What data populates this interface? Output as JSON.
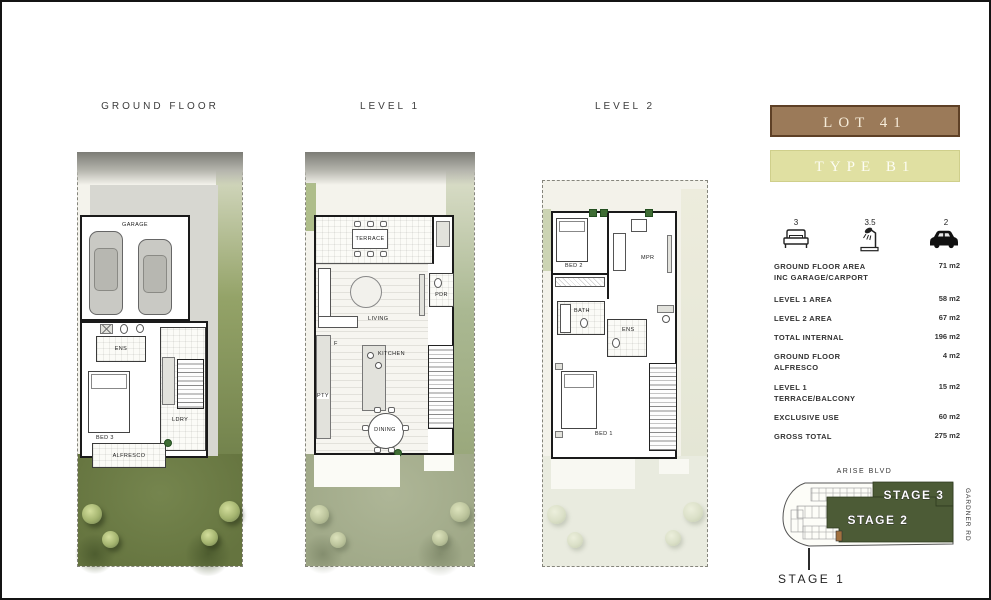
{
  "plans": {
    "ground": {
      "title": "GROUND FLOOR",
      "rooms": {
        "garage": "GARAGE",
        "ens": "ENS",
        "bed3": "BED 3",
        "ldry": "LDRY",
        "alfresco": "ALFRESCO"
      }
    },
    "level1": {
      "title": "LEVEL 1",
      "rooms": {
        "terrace": "TERRACE",
        "living": "LIVING",
        "kitchen": "KITCHEN",
        "pdr": "PDR",
        "fridge": "F",
        "pty": "PTY",
        "dining": "DINING"
      }
    },
    "level2": {
      "title": "LEVEL 2",
      "rooms": {
        "bed2": "BED 2",
        "mpr": "MPR",
        "bath": "BATH",
        "ens": "ENS",
        "bed1": "BED 1"
      }
    }
  },
  "sidebar": {
    "lot_label": "LOT 41",
    "type_label": "TYPE B1",
    "features": {
      "beds": "3",
      "baths": "3.5",
      "cars": "2"
    },
    "areas": [
      {
        "label": "GROUND FLOOR AREA",
        "label2": "INC GARAGE/CARPORT",
        "value": "71 m2"
      },
      {
        "label": "LEVEL 1 AREA",
        "label2": "",
        "value": "58 m2"
      },
      {
        "label": "LEVEL 2 AREA",
        "label2": "",
        "value": "67 m2"
      },
      {
        "label": "TOTAL INTERNAL",
        "label2": "",
        "value": "196 m2"
      },
      {
        "label": "GROUND FLOOR",
        "label2": "ALFRESCO",
        "value": "4 m2"
      },
      {
        "label": "LEVEL 1",
        "label2": "TERRACE/BALCONY",
        "value": "15 m2"
      },
      {
        "label": "EXCLUSIVE USE",
        "label2": "",
        "value": "60 m2"
      },
      {
        "label": "GROSS TOTAL",
        "label2": "",
        "value": "275 m2"
      }
    ],
    "site": {
      "street_top": "ARISE BLVD",
      "street_right": "GARDNER RD",
      "stage1": "STAGE 1",
      "stage2": "STAGE 2",
      "stage3": "STAGE 3"
    }
  },
  "colors": {
    "lot_banner_bg": "#9b7a59",
    "lot_banner_border": "#5e4026",
    "type_banner_bg": "#e0e0a2",
    "stage_green": "#4c5b36",
    "lot_highlight": "#a2713f",
    "grass_ground": "#6d7c49",
    "grass_level1": "#a9b193",
    "grass_level2": "#e9ebdf"
  }
}
